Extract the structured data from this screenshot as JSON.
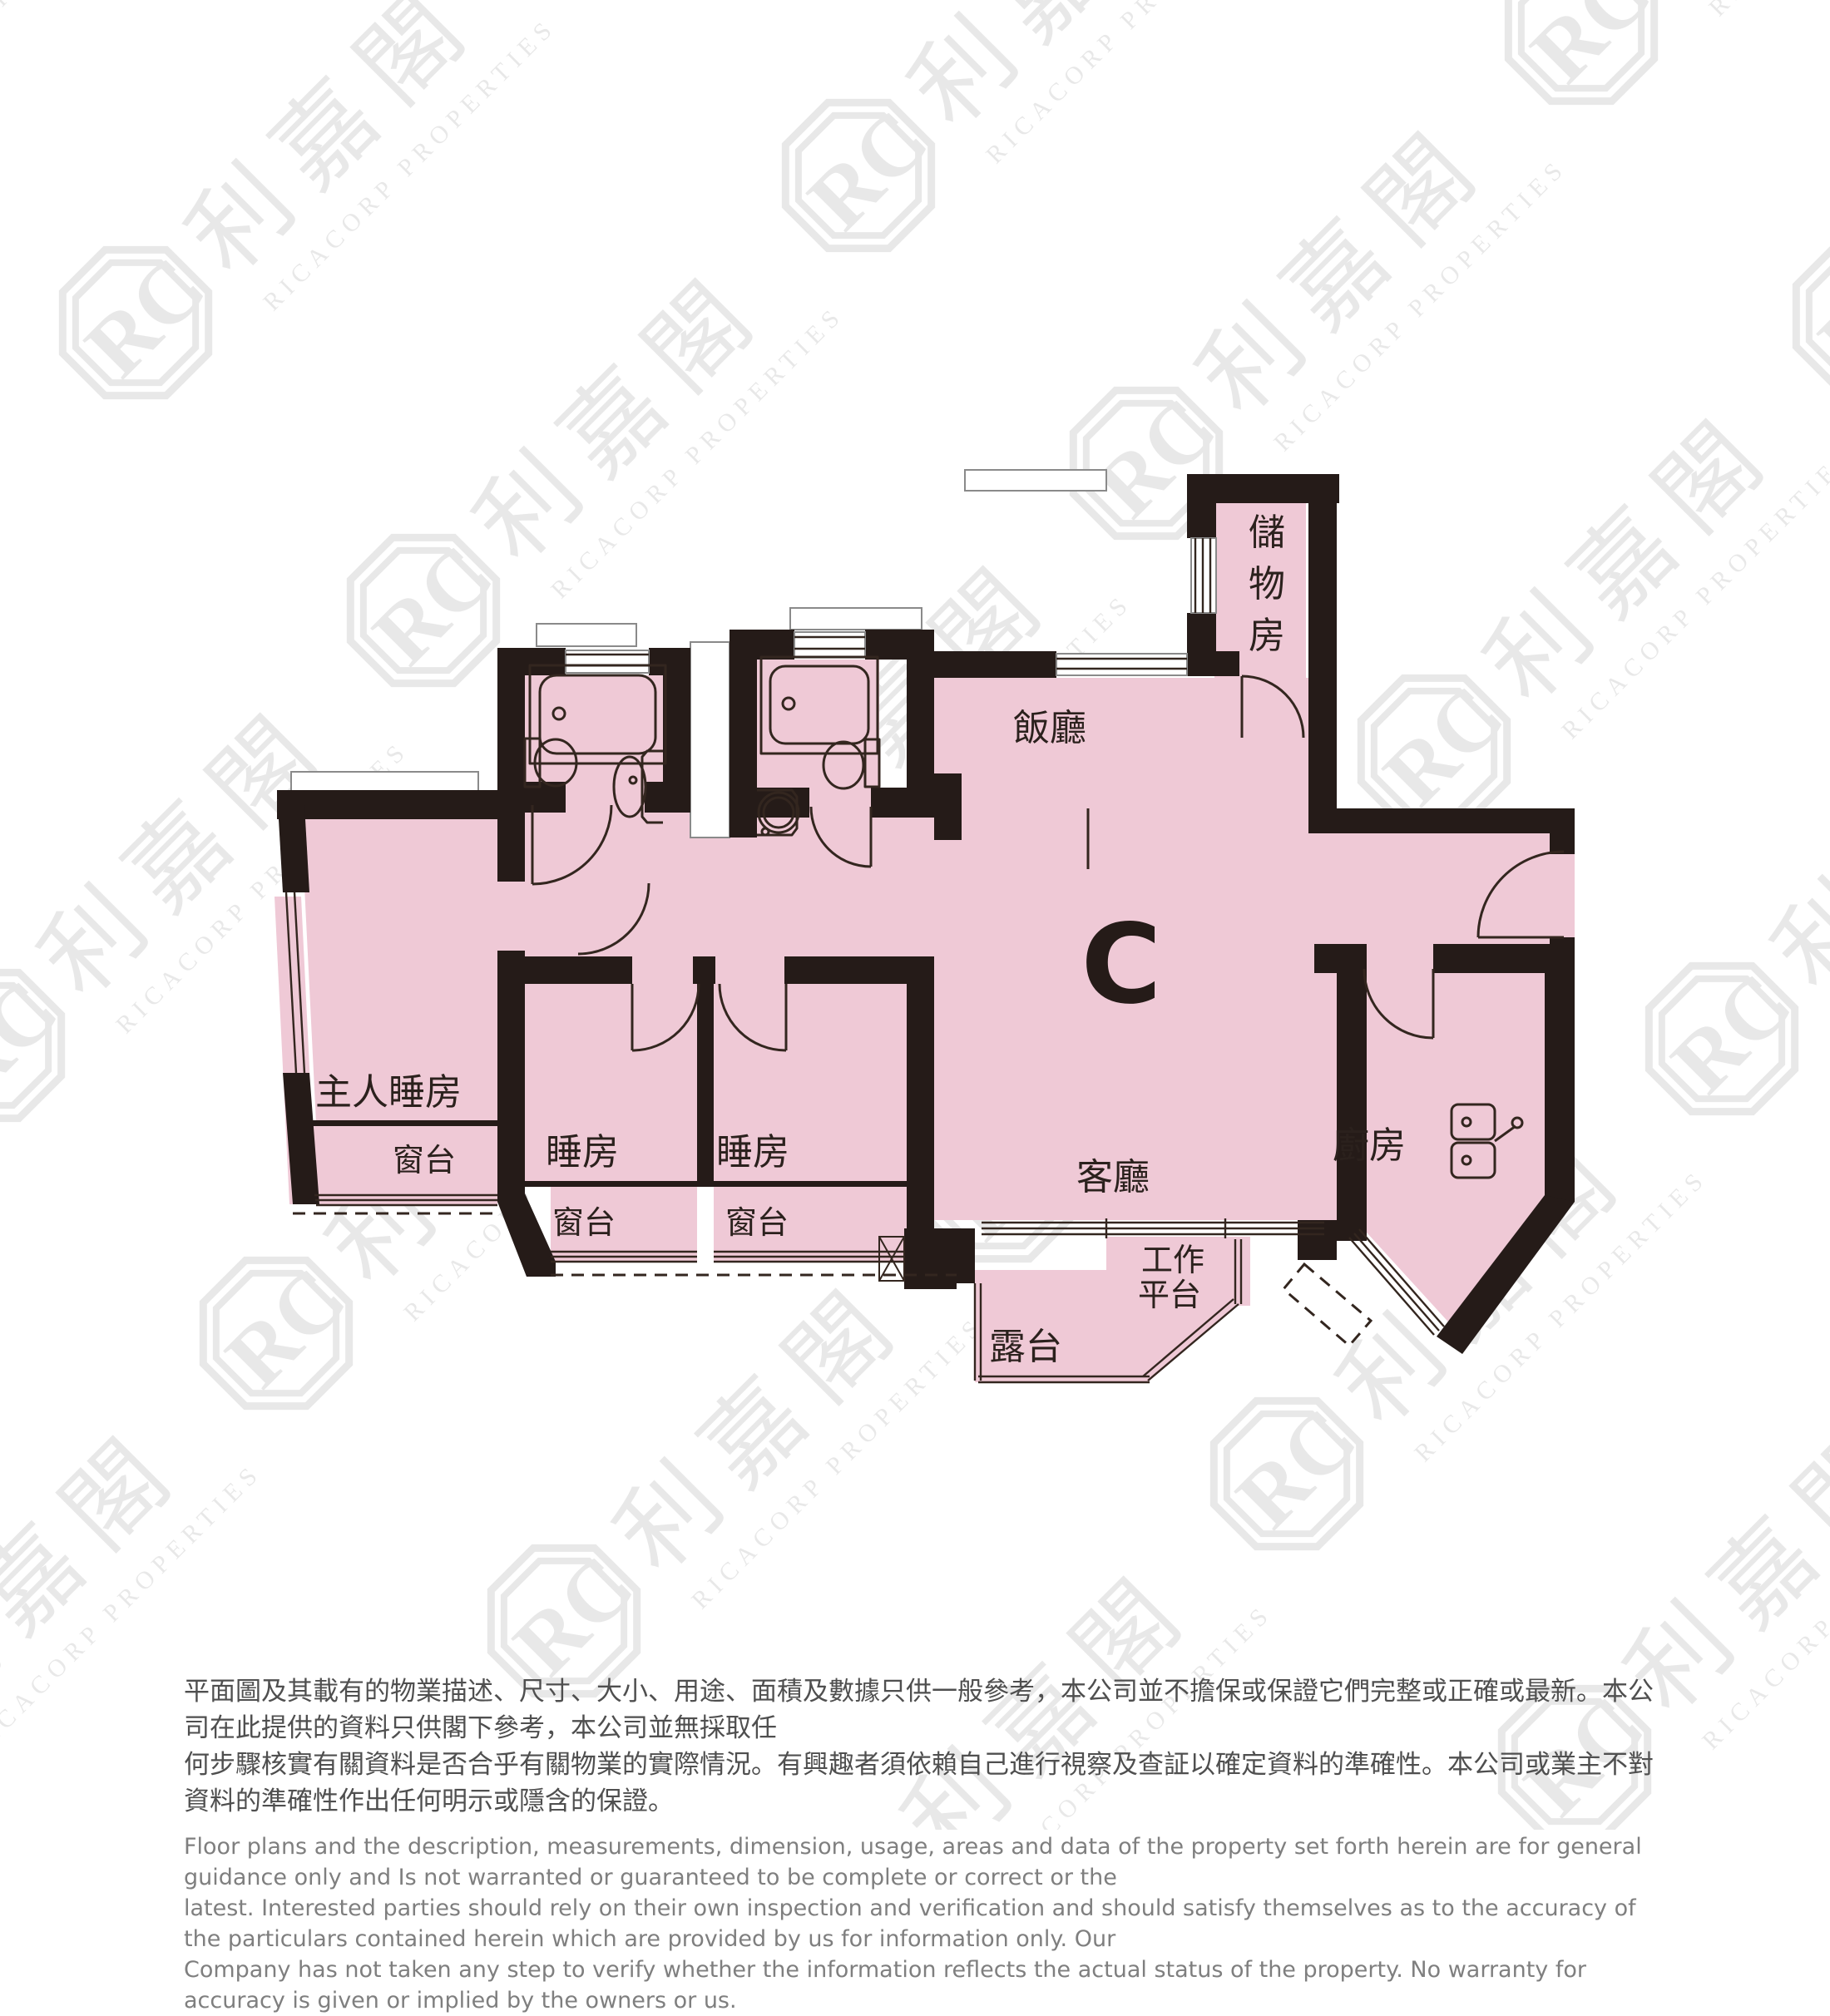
{
  "unit": {
    "label": "C"
  },
  "rooms": {
    "master_bedroom": "主人睡房",
    "master_bay": "窗台",
    "bedroom1": "睡房",
    "bedroom1_bay": "窗台",
    "bedroom2": "睡房",
    "bedroom2_bay": "窗台",
    "dining": "飯廳",
    "living": "客廳",
    "kitchen": "廚房",
    "balcony": "露台",
    "utility_line1": "工作",
    "utility_line2": "平台",
    "storage_char1": "儲",
    "storage_char2": "物",
    "storage_char3": "房"
  },
  "watermark": {
    "logo": "ricacorp-rc-octagon-logo",
    "monogram": "RC",
    "cjk": "利嘉閣",
    "latin": "RICACORP PROPERTIES"
  },
  "disclaimer": {
    "zh_line1": "平面圖及其載有的物業描述、尺寸、大小、用途、面積及數據只供一般參考，本公司並不擔保或保證它們完整或正確或最新。本公司在此提供的資料只供閣下參考，本公司並無採取任",
    "zh_line2": "何步驟核實有關資料是否合乎有關物業的實際情況。有興趣者須依賴自己進行視察及查証以確定資料的準確性。本公司或業主不對資料的準確性作出任何明示或隱含的保證。",
    "en_line1": "Floor plans and the description, measurements, dimension, usage, areas and data of the property set forth herein are for general guidance only and Is not warranted or guaranteed to be complete or correct or the",
    "en_line2": "latest. Interested parties should rely on their own inspection and verification and should satisfy themselves as to the accuracy of the particulars contained herein which are provided by us for information only.  Our",
    "en_line3": "Company has not taken any step to verify whether the information reflects the actual status of the property.  No warranty for accuracy is given or implied by the owners or us."
  },
  "colors": {
    "floor_pink": "#efc9d6",
    "wall_dark": "#251b18",
    "line": "#33261f",
    "label_text": "#2b211d",
    "disclaimer_zh": "#4f4f4f",
    "disclaimer_en": "#7f7f7f"
  }
}
